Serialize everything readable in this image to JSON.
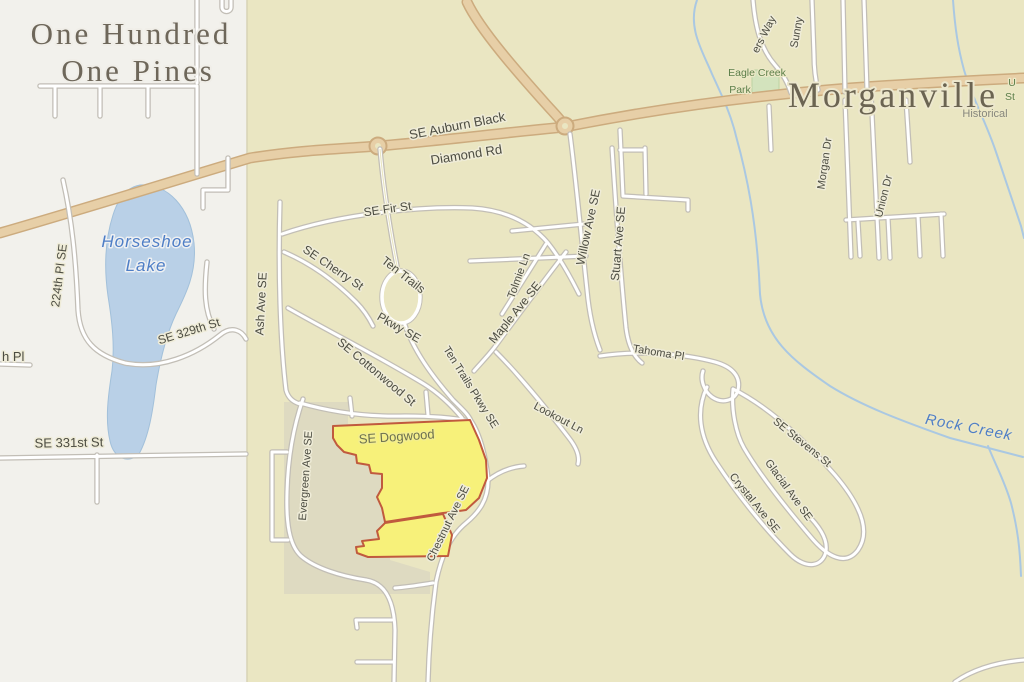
{
  "map": {
    "places": {
      "neighborhood_line1": "One Hundred",
      "neighborhood_line2": "One Pines",
      "town": "Morganville"
    },
    "water": {
      "lake_line1": "Horseshoe",
      "lake_line2": "Lake",
      "creek": "Rock Creek"
    },
    "park": {
      "eagle_creek_line1": "Eagle Creek",
      "eagle_creek_line2": "Park",
      "corner_partial_line1": "U",
      "corner_partial_line2": "St"
    },
    "poi": {
      "historical": "Historical"
    },
    "streets": {
      "auburn1": "SE Auburn Black",
      "auburn2": "Diamond Rd",
      "fir": "SE Fir St",
      "cherry": "SE Cherry St",
      "tentrails_n1": "Ten Trails",
      "tentrails_n2": "Pkwy SE",
      "tentrails_s": "Ten Trails Pkwy SE",
      "cottonwood": "SE Cottonwood St",
      "maple": "Maple Ave SE",
      "tolmie": "Tolmie Ln",
      "willow": "Willow Ave SE",
      "stuart": "Stuart Ave SE",
      "tahoma": "Tahoma Pl",
      "lookout": "Lookout Ln",
      "stevens": "SE Stevens St",
      "glacial": "Glacial Ave SE",
      "crystal": "Crystal Ave SE",
      "chestnut": "Chestnut Ave SE",
      "dogwood": "SE Dogwood",
      "evergreen": "Evergreen Ave SE",
      "ash": "Ash Ave SE",
      "pl224": "224th Pl SE",
      "st329": "SE 329th St",
      "st331": "SE 331st St",
      "hpl_partial": "h Pl",
      "morgan": "Morgan Dr",
      "union": "Union Dr",
      "ersway_partial": "ers Way",
      "sunny": "Sunny"
    },
    "colors": {
      "background": "#eae6c2",
      "urban_area": "#f2f1ec",
      "older_area": "#dedac1",
      "water": "#b9d0e7",
      "major_road": "#e7cfa7",
      "parcel_fill": "#f7f17a",
      "parcel_stroke": "#c05a3e",
      "park_green": "#d3e3bd"
    }
  }
}
